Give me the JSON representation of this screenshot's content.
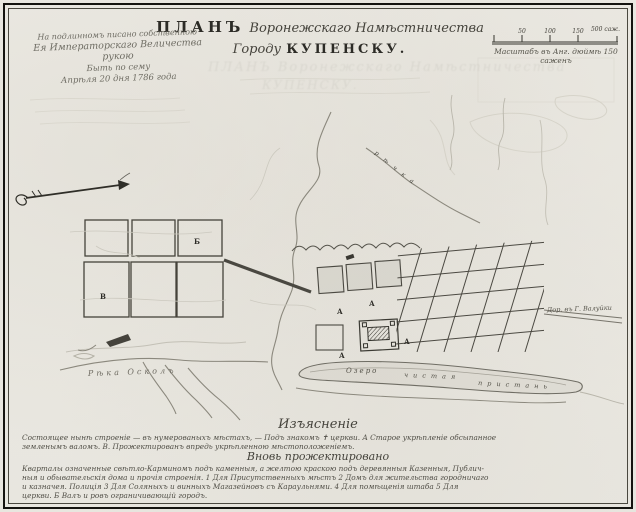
{
  "document": {
    "title_word": "ПЛАНЪ",
    "title_script": "Воронежскаго Намѣстничества",
    "title_line2_script": "Городу",
    "title_city": "КУПЕНСКУ.",
    "approval_note": {
      "line1": "На подлинномъ писано собственною",
      "line2": "Ея Императорскаго Величества рукою",
      "line3": "Быть по сему",
      "line4": "Апрѣля 20 дня 1786 года"
    },
    "scale_bar": {
      "tick_labels": [
        "50",
        "100",
        "150"
      ],
      "end_label": "500 саж.",
      "caption": "Масштабъ въ Анг. дюймѣ 150 саженъ"
    }
  },
  "map": {
    "labels": {
      "river_main": "Рѣка  Осколъ",
      "lake_word1": "Озеро",
      "lake_word2": "чистая",
      "lake_word3": "пристань",
      "stream": "рѣчка",
      "road_east": "Дор. въ Г. Валуйки"
    },
    "block_letters": {
      "b": "Б",
      "v": "В",
      "a": "А"
    }
  },
  "legend": {
    "heading": "Изъясненіе",
    "line1": "Состоящее нынѣ строеніе — въ нумерованыхъ мѣстахъ, — Подъ знакомъ ✝ церкви.      А  Старое укрѣпленіе обсыпанное",
    "line2": "земленымъ валомъ.    В.  Прожектированъ впредь укрѣпленною мѣстоположеніемъ.",
    "subheading": "Вновь прожектировано",
    "paragraph": [
      "Кварталы означенные свѣтло-Карминомъ подъ каменныя, а желтою краскою подъ деревянныя Казенныя, Публич-",
      "ныя и обывательскія дома и прочія строенія.  1 Для Присутственныхъ мѣстъ  2 Домъ для жительства городничаго",
      "и казначея. Полиція  3 Для Соляныхъ и винныхъ Магазейновъ съ Караульнями.  4 Для помѣщенія штаба  5 Для",
      "церкви.  Б  Валъ и ровъ ограничивающій городъ."
    ]
  }
}
